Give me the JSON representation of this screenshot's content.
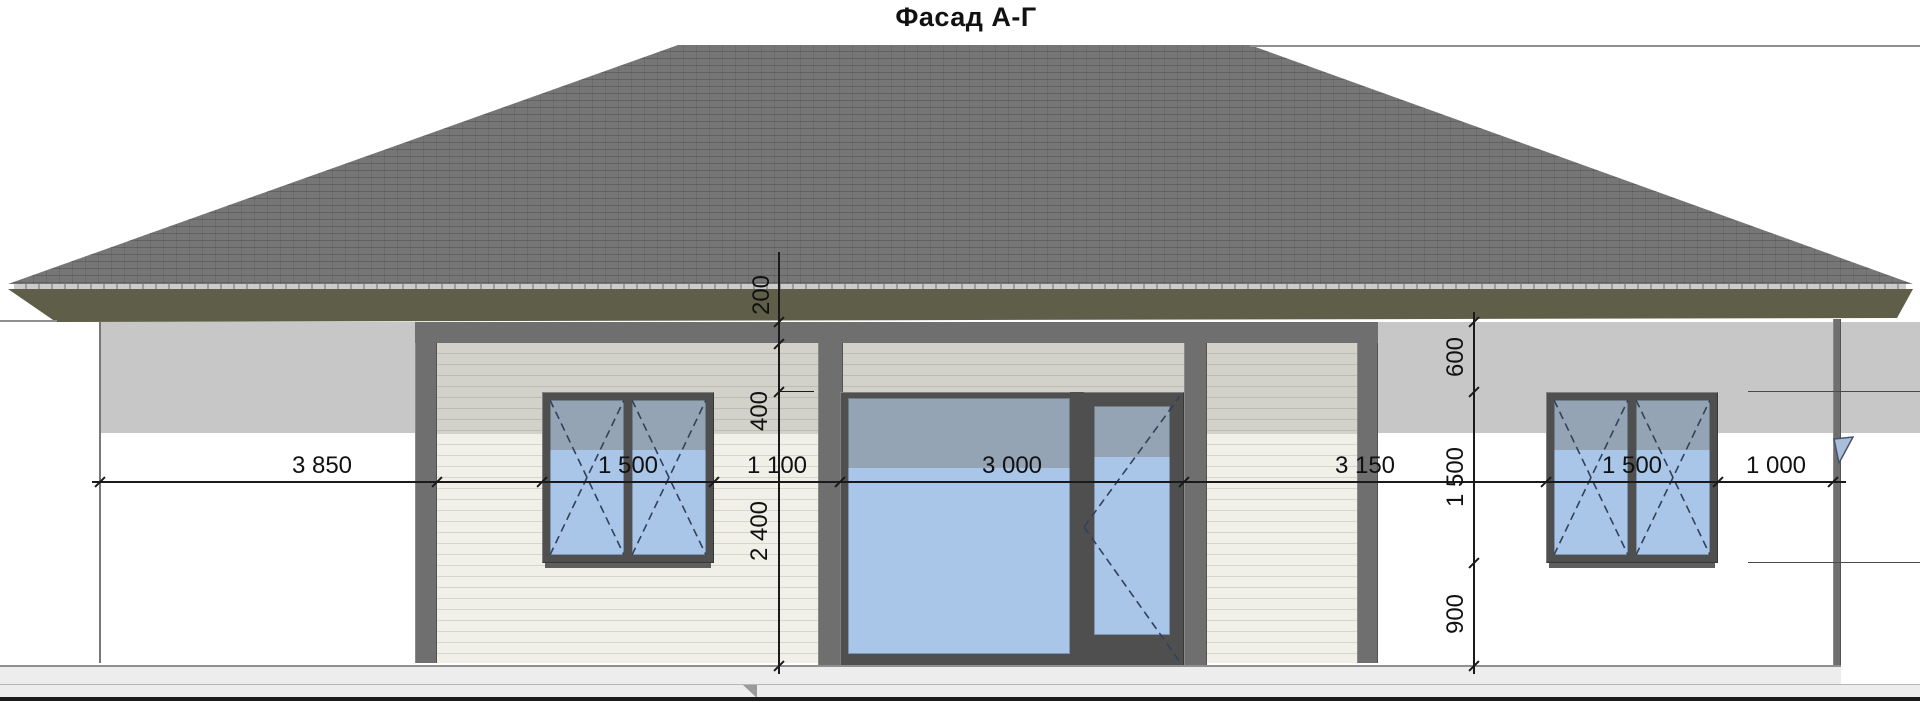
{
  "title": "Фасад А-Г",
  "dims": {
    "horizontal": {
      "labels": [
        "3 850",
        "1 500",
        "1 100",
        "3 000",
        "3 150",
        "1 500",
        "1 000"
      ]
    },
    "vertical_left": {
      "labels": [
        "200",
        "400",
        "2 400"
      ]
    },
    "vertical_right": {
      "labels": [
        "600",
        "1 500",
        "900"
      ]
    }
  },
  "colors": {
    "roof_base": "#767676",
    "roof_row_line": "rgba(0,0,0,0.17)",
    "roof_joint": "rgba(0,0,0,0.09)",
    "eave_strip": "#cccccc",
    "eave_tick": "#9c9c9c",
    "fascia": "#5e5e49",
    "wall_white": "#ffffff",
    "wall_shadow": "#c7c7c7",
    "beam_gray": "#6f6f6f",
    "frame_dark": "#4f4f4f",
    "siding_lit": "#f0efe8",
    "siding_lit_line": "#d7d5ca",
    "siding_shade": "#d3d2ca",
    "siding_shade_line": "#bdbbb2",
    "glass_shade": "#94a4b5",
    "glass_lit": "#a9c5e8",
    "dash_blue": "#32415a",
    "dim_color": "#1a1a1a",
    "ground_band": "#ededed",
    "ground_line": "#8f8f8f",
    "ground_line_2": "#b6b6b6",
    "ground_dark": "#1b1b1b",
    "marker_fill": "#aabdd9",
    "marker_stroke": "#44546b"
  }
}
